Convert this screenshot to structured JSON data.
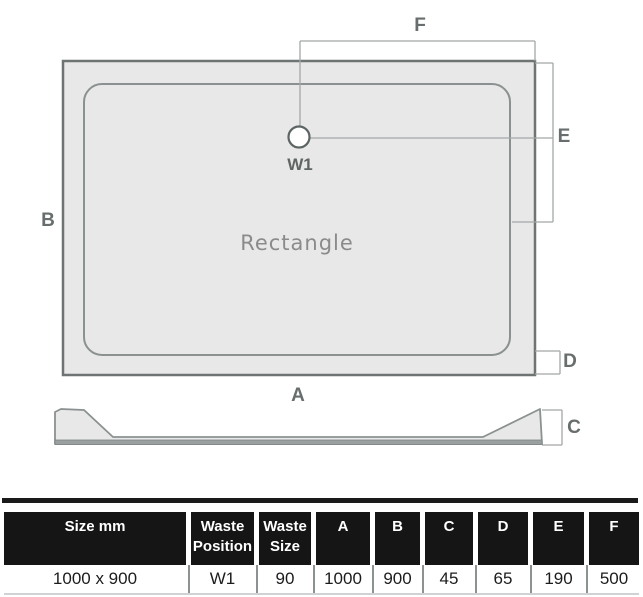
{
  "diagram": {
    "shape_label": "Rectangle",
    "waste_label": "W1",
    "dimension_labels": {
      "top": "F",
      "right": "E",
      "left": "B",
      "bottom": "A",
      "bottom_right": "D",
      "profile_height": "C"
    },
    "colors": {
      "tray_fill": "#e8e8e8",
      "tray_border": "#6e7373",
      "inner_border": "#8b9090",
      "dimension_line": "#a3a8a8",
      "label_text": "#686d6d",
      "profile_base_band": "#9aa0a0",
      "table_header_bg": "#151515",
      "table_header_text": "#ffffff"
    }
  },
  "table": {
    "headers": [
      "Size mm",
      "Waste\nPosition",
      "Waste\nSize",
      "A",
      "B",
      "C",
      "D",
      "E",
      "F"
    ],
    "row": [
      "1000 x 900",
      "W1",
      "90",
      "1000",
      "900",
      "45",
      "65",
      "190",
      "500"
    ]
  }
}
